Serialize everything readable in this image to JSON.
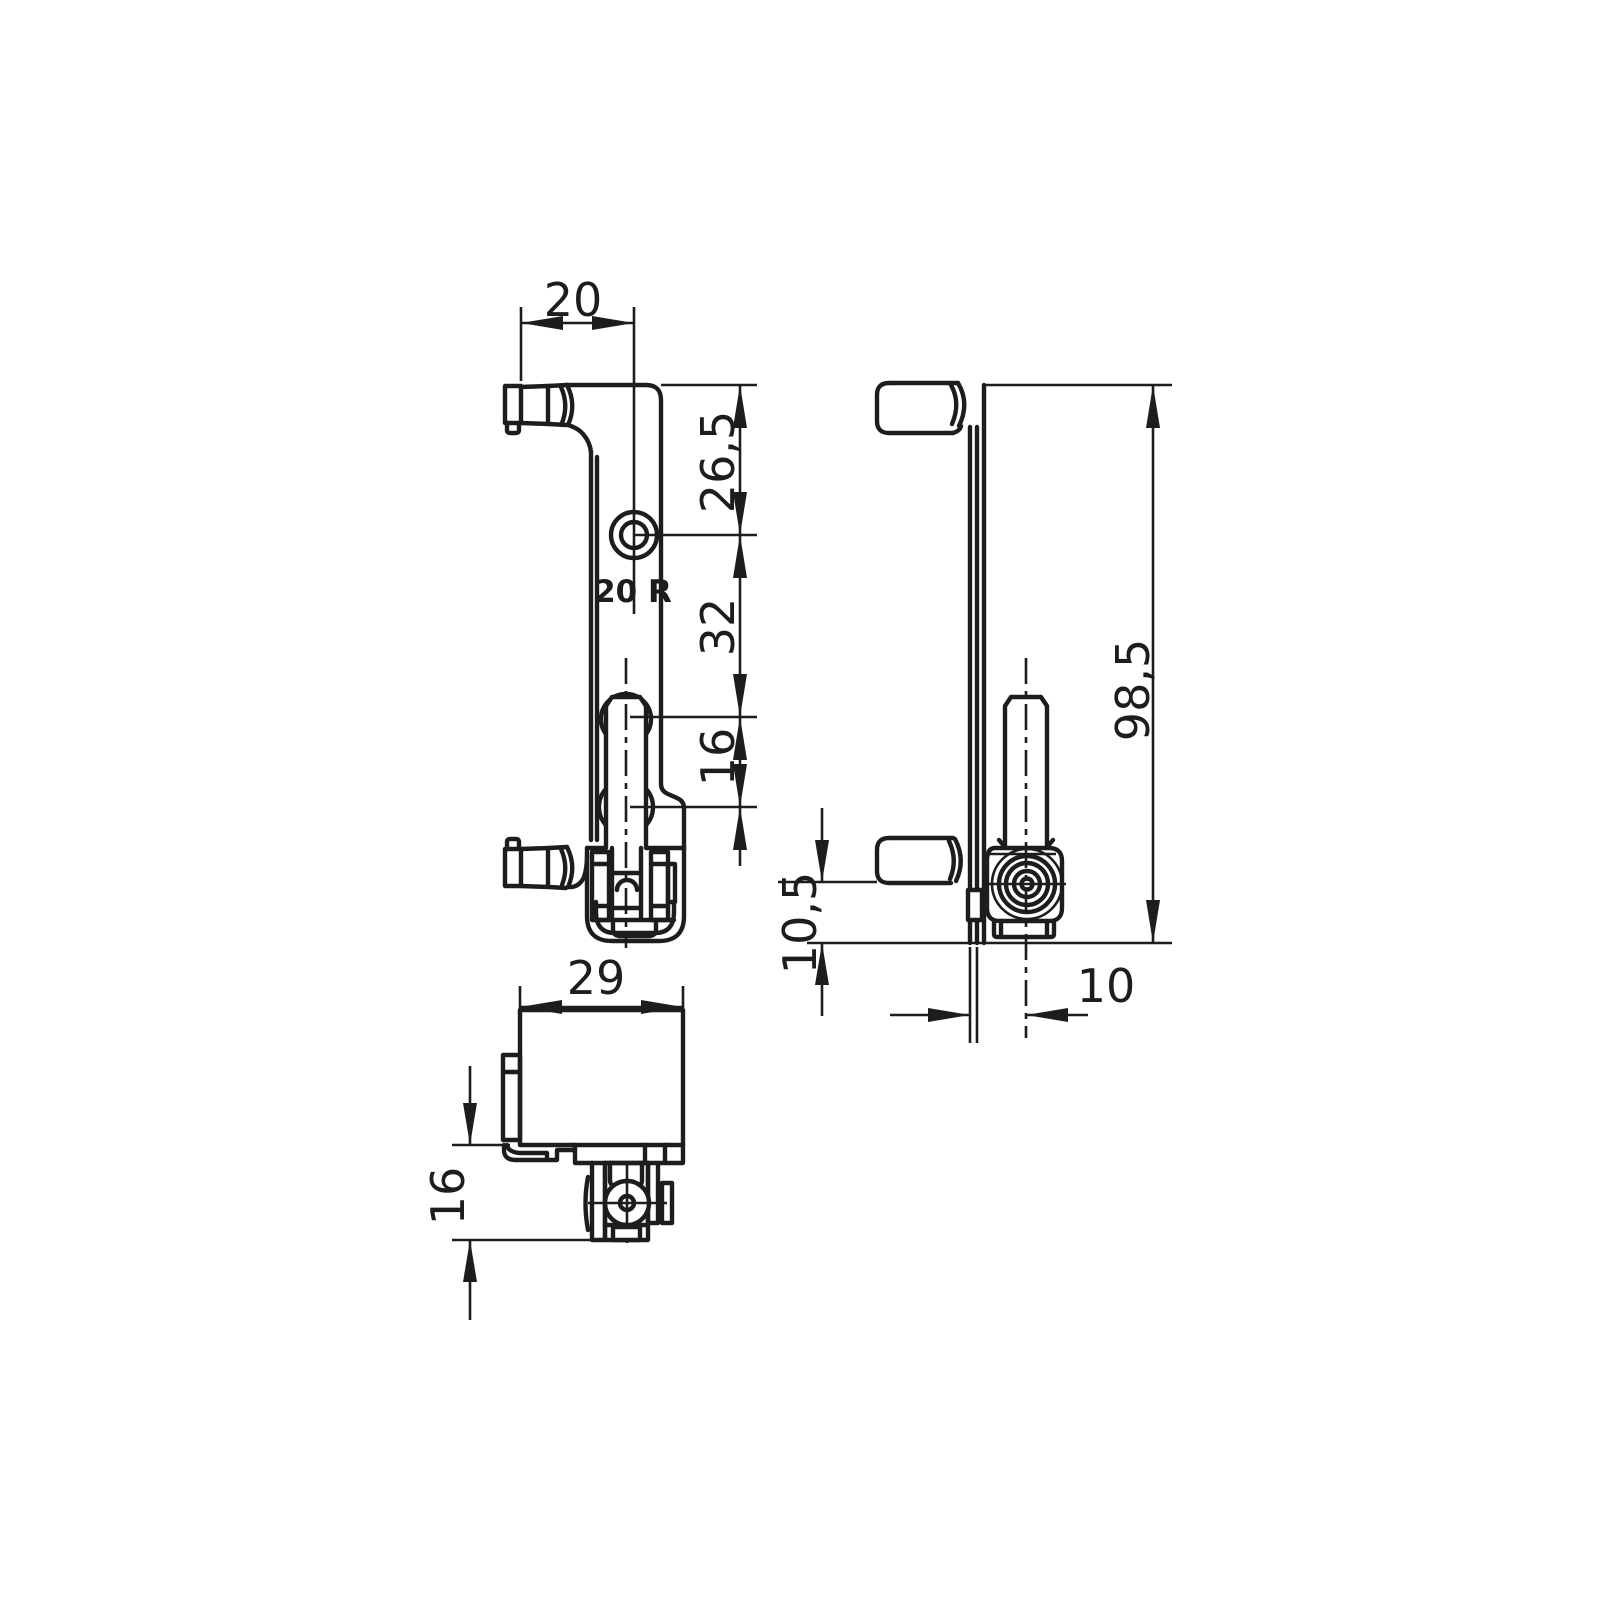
{
  "drawing": {
    "type": "technical-orthographic-drawing",
    "colors": {
      "ink": "#1d1d1b",
      "background": "#ffffff"
    },
    "marking": {
      "label": "20 R"
    },
    "dims": {
      "pin_offset_20": {
        "label": "20"
      },
      "top_to_hole_265": {
        "label": "26,5"
      },
      "hole_to_roller_32": {
        "label": "32"
      },
      "roller_len_16": {
        "label": "16"
      },
      "overall_985": {
        "label": "98,5"
      },
      "base_105": {
        "label": "10,5"
      },
      "axis_offset_10": {
        "label": "10"
      },
      "body_width_29": {
        "label": "29"
      },
      "body_depth_16": {
        "label": "16"
      }
    }
  }
}
